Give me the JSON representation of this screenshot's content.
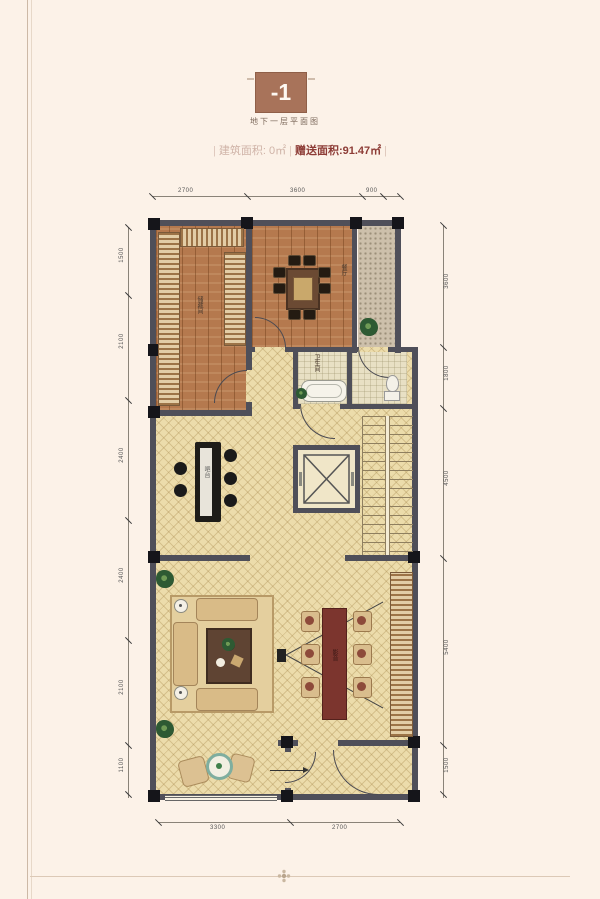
{
  "header": {
    "badge": "-1",
    "caption": "地下一层平面图",
    "area": {
      "open": "|",
      "label1": "建筑面积:",
      "value1": "0㎡",
      "mid": "|",
      "label2": "赠送面积:",
      "value2": "91.47㎡",
      "close": "|"
    }
  },
  "plan": {
    "room_labels": {
      "storage": "储藏间",
      "dining": "餐厅",
      "bath": "卫生间",
      "bar": "吧台",
      "theater": "影音"
    }
  },
  "dimensions": {
    "top": [
      "2700",
      "3600",
      "900"
    ],
    "bottom": [
      "3300",
      "2700"
    ],
    "left": [
      "1500",
      "2100",
      "2400",
      "2400",
      "2100",
      "1100"
    ],
    "right": [
      "3600",
      "1800",
      "4500",
      "5400",
      "1500"
    ]
  },
  "colors": {
    "badge_bg": "#a8735a",
    "area_accent": "#8d3c36",
    "wall": "#4f4f59",
    "tile_floor": "#ecdcab",
    "wood_floor": "#b5794e",
    "page_bg": "#fcf2e8"
  }
}
